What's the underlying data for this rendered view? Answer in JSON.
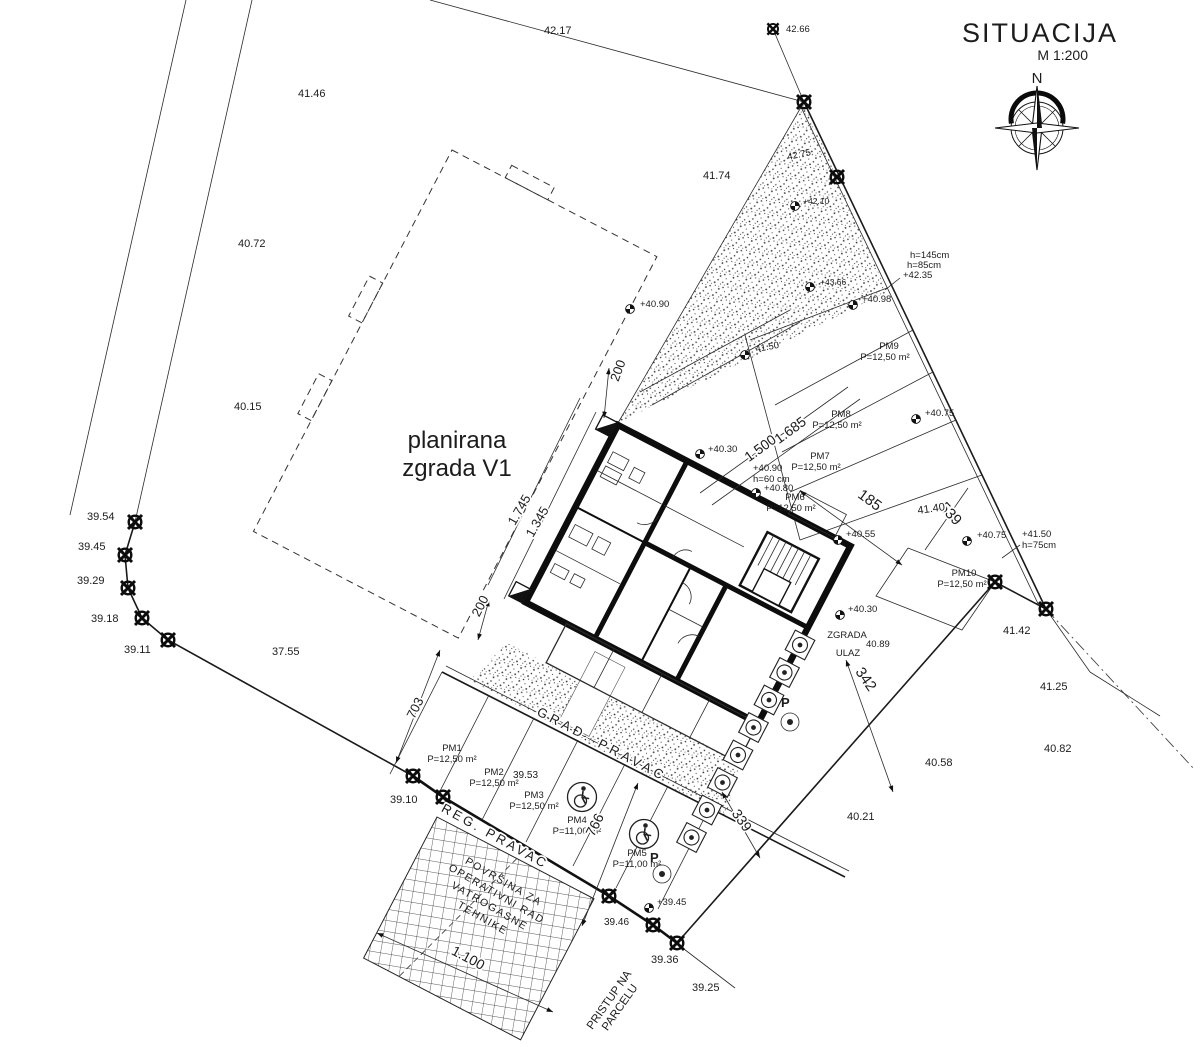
{
  "title": {
    "name": "SITUACIJA",
    "scale": "M 1:200",
    "north_label": "N"
  },
  "labels": {
    "building": {
      "line1": "planirana",
      "line2": "zgrada V1"
    },
    "entrance": {
      "line1": "ZGRADA",
      "line2": "ULAZ"
    },
    "grad_pravac": "GRAĐ. PRAVAC",
    "reg_pravac": "REG. PRAVAC",
    "access": {
      "line1": "PRISTUP NA",
      "line2": "PARCELU"
    },
    "fire_area": {
      "line1": "POVRŠINA ZA",
      "line2": "OPERATIVNI RAD",
      "line3": "VATROGASNE",
      "line4": "TEHNIKE"
    },
    "p_sign": "P"
  },
  "icons": {
    "accessible": "wheelchair",
    "compass": "compass-rose",
    "boundary_marker": "survey-cross",
    "spot_marker": "benchmark"
  },
  "parking": {
    "pm1": {
      "id": "PM1",
      "area": "P=12,50 m²"
    },
    "pm2": {
      "id": "PM2",
      "area": "P=12,50 m²"
    },
    "pm3": {
      "id": "PM3",
      "area": "P=12,50 m²"
    },
    "pm4": {
      "id": "PM4",
      "area": "P=11,00 m²"
    },
    "pm5": {
      "id": "PM5",
      "area": "P=11,00 m²"
    },
    "pm6": {
      "id": "PM6",
      "area": "P=12,50 m²"
    },
    "pm7": {
      "id": "PM7",
      "area": "P=12,50 m²"
    },
    "pm8": {
      "id": "PM8",
      "area": "P=12,50 m²"
    },
    "pm9": {
      "id": "PM9",
      "area": "P=12,50 m²"
    },
    "pm10": {
      "id": "PM10",
      "area": "P=12,50 m²"
    }
  },
  "dimensions": {
    "d200_top": "200",
    "d200_left": "200",
    "d1745": "1.745",
    "d1345": "1.345",
    "d1500": "1.500",
    "d1685": "1.685",
    "d185": "185",
    "d539": "539",
    "d342": "342",
    "d339": "339",
    "d703": "703",
    "d766": "766",
    "d1100": "1.100"
  },
  "spot_heights": {
    "s4090a": "+40.90",
    "s4030a": "+40.30",
    "s4090b": "+40.90",
    "h60": "h=60 cm",
    "s4080": "+40.80",
    "s4055": "+40.55",
    "s4030b": "+40.30",
    "s3945": "+39.45",
    "s4150": "+41.50",
    "h75": "h=75cm",
    "s4075a": "+40.75",
    "s4075b": "+40.75",
    "s4235": "+42.35",
    "h145": "h=145cm",
    "h85": "h=85cm",
    "s4098": "+40.98",
    "s4366": "+43.66",
    "s4210": "+42.10",
    "s4150b": "41.50",
    "s4275": "42.75",
    "s4266": "42.66"
  },
  "ground_elevations": {
    "e4217": "42.17",
    "e4146": "41.46",
    "e4072": "40.72",
    "e4015": "40.15",
    "e3954": "39.54",
    "e3945": "39.45",
    "e3929": "39.29",
    "e3918": "39.18",
    "e3911": "39.11",
    "e3755": "37.55",
    "e4174": "41.74",
    "e4140": "41.40",
    "e4142": "41.42",
    "e4125": "41.25",
    "e4082": "40.82",
    "e4058": "40.58",
    "e4021": "40.21",
    "e4089": "40.89",
    "e3953": "39.53",
    "e3910": "39.10",
    "e3946": "39.46",
    "e3936": "39.36",
    "e3925": "39.25"
  }
}
